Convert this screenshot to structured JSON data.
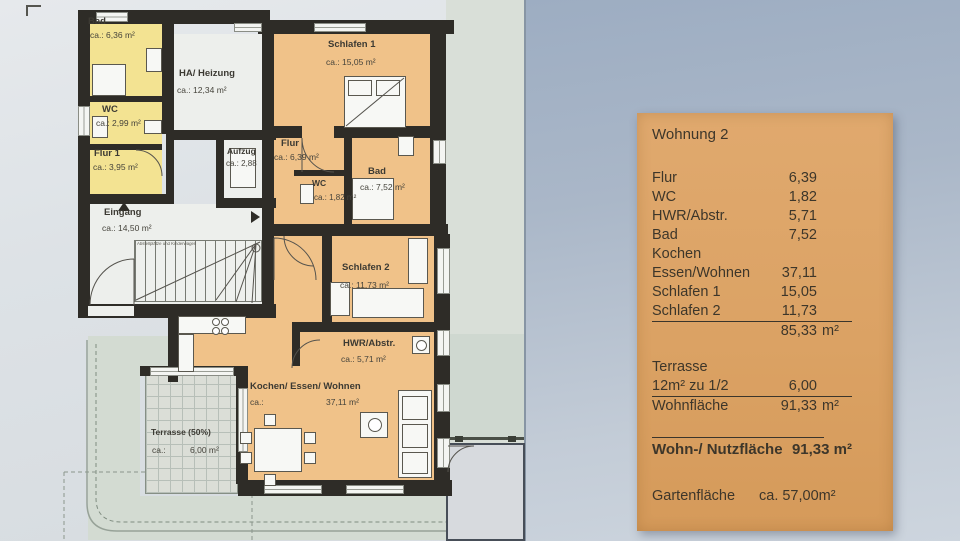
{
  "plan": {
    "rooms": {
      "bad_gelb": {
        "name": "Bad",
        "area": "ca.: 6,36 m²"
      },
      "wc_gelb": {
        "name": "WC",
        "area": "ca.: 2,99 m²"
      },
      "flur1": {
        "name": "Flur 1",
        "area": "ca.: 3,95 m²"
      },
      "heizung": {
        "name": "HA/ Heizung",
        "area": "ca.: 12,34 m²"
      },
      "aufzug": {
        "name": "Aufzug",
        "area": "ca.: 2,88"
      },
      "eingang": {
        "name": "Eingang",
        "area": "ca.: 14,50 m²"
      },
      "schlafen1": {
        "name": "Schlafen 1",
        "area": "ca.: 15,05 m²"
      },
      "flur": {
        "name": "Flur",
        "area": "ca.: 6,39 m²"
      },
      "bad": {
        "name": "Bad",
        "area": "ca.: 7,52 m²"
      },
      "wc": {
        "name": "WC",
        "area": "ca.: 1,82 m²"
      },
      "schlafen2": {
        "name": "Schlafen 2",
        "area": "ca.: 11,73 m²"
      },
      "hwr": {
        "name": "HWR/Abstr.",
        "area": "ca.:  5,71 m²"
      },
      "wohnen": {
        "name": "Kochen/ Essen/ Wohnen",
        "prefix": "ca.:",
        "area": "37,11 m²"
      },
      "terrasse": {
        "name": "Terrasse (50%)",
        "prefix": "ca.:",
        "area": "6,00 m²"
      }
    },
    "stair_note": "Abstellplätze und Kinderwagen"
  },
  "panel": {
    "title": "Wohnung 2",
    "rows": [
      {
        "label": "Flur",
        "value": "6,39"
      },
      {
        "label": "WC",
        "value": "1,82"
      },
      {
        "label": "HWR/Abstr.",
        "value": "5,71"
      },
      {
        "label": "Bad",
        "value": "7,52"
      },
      {
        "label": "Kochen",
        "value": ""
      },
      {
        "label": "Essen/Wohnen",
        "value": "37,11"
      },
      {
        "label": "Schlafen 1",
        "value": "15,05"
      },
      {
        "label": "Schlafen 2",
        "value": "11,73"
      }
    ],
    "subtotal": {
      "value": "85,33",
      "unit": "m²"
    },
    "terrasse_heading": "Terrasse",
    "terrasse_row": {
      "label": "12m² zu 1/2",
      "value": "6,00"
    },
    "wohnflaeche_row": {
      "label": "Wohnfläche",
      "value": "91,33",
      "unit": "m²"
    },
    "total_row": {
      "label": "Wohn-/ Nutzfläche",
      "value": "91,33 m²"
    },
    "garten_row": {
      "label": "Gartenfläche",
      "value": "ca. 57,00m²"
    }
  },
  "colors": {
    "panel_orange": "#dda466",
    "room_orange": "#f0c289",
    "room_yellow": "#f3e392",
    "wall_dark": "#2e2c27",
    "backdrop_blue": "#a3b2c6"
  }
}
